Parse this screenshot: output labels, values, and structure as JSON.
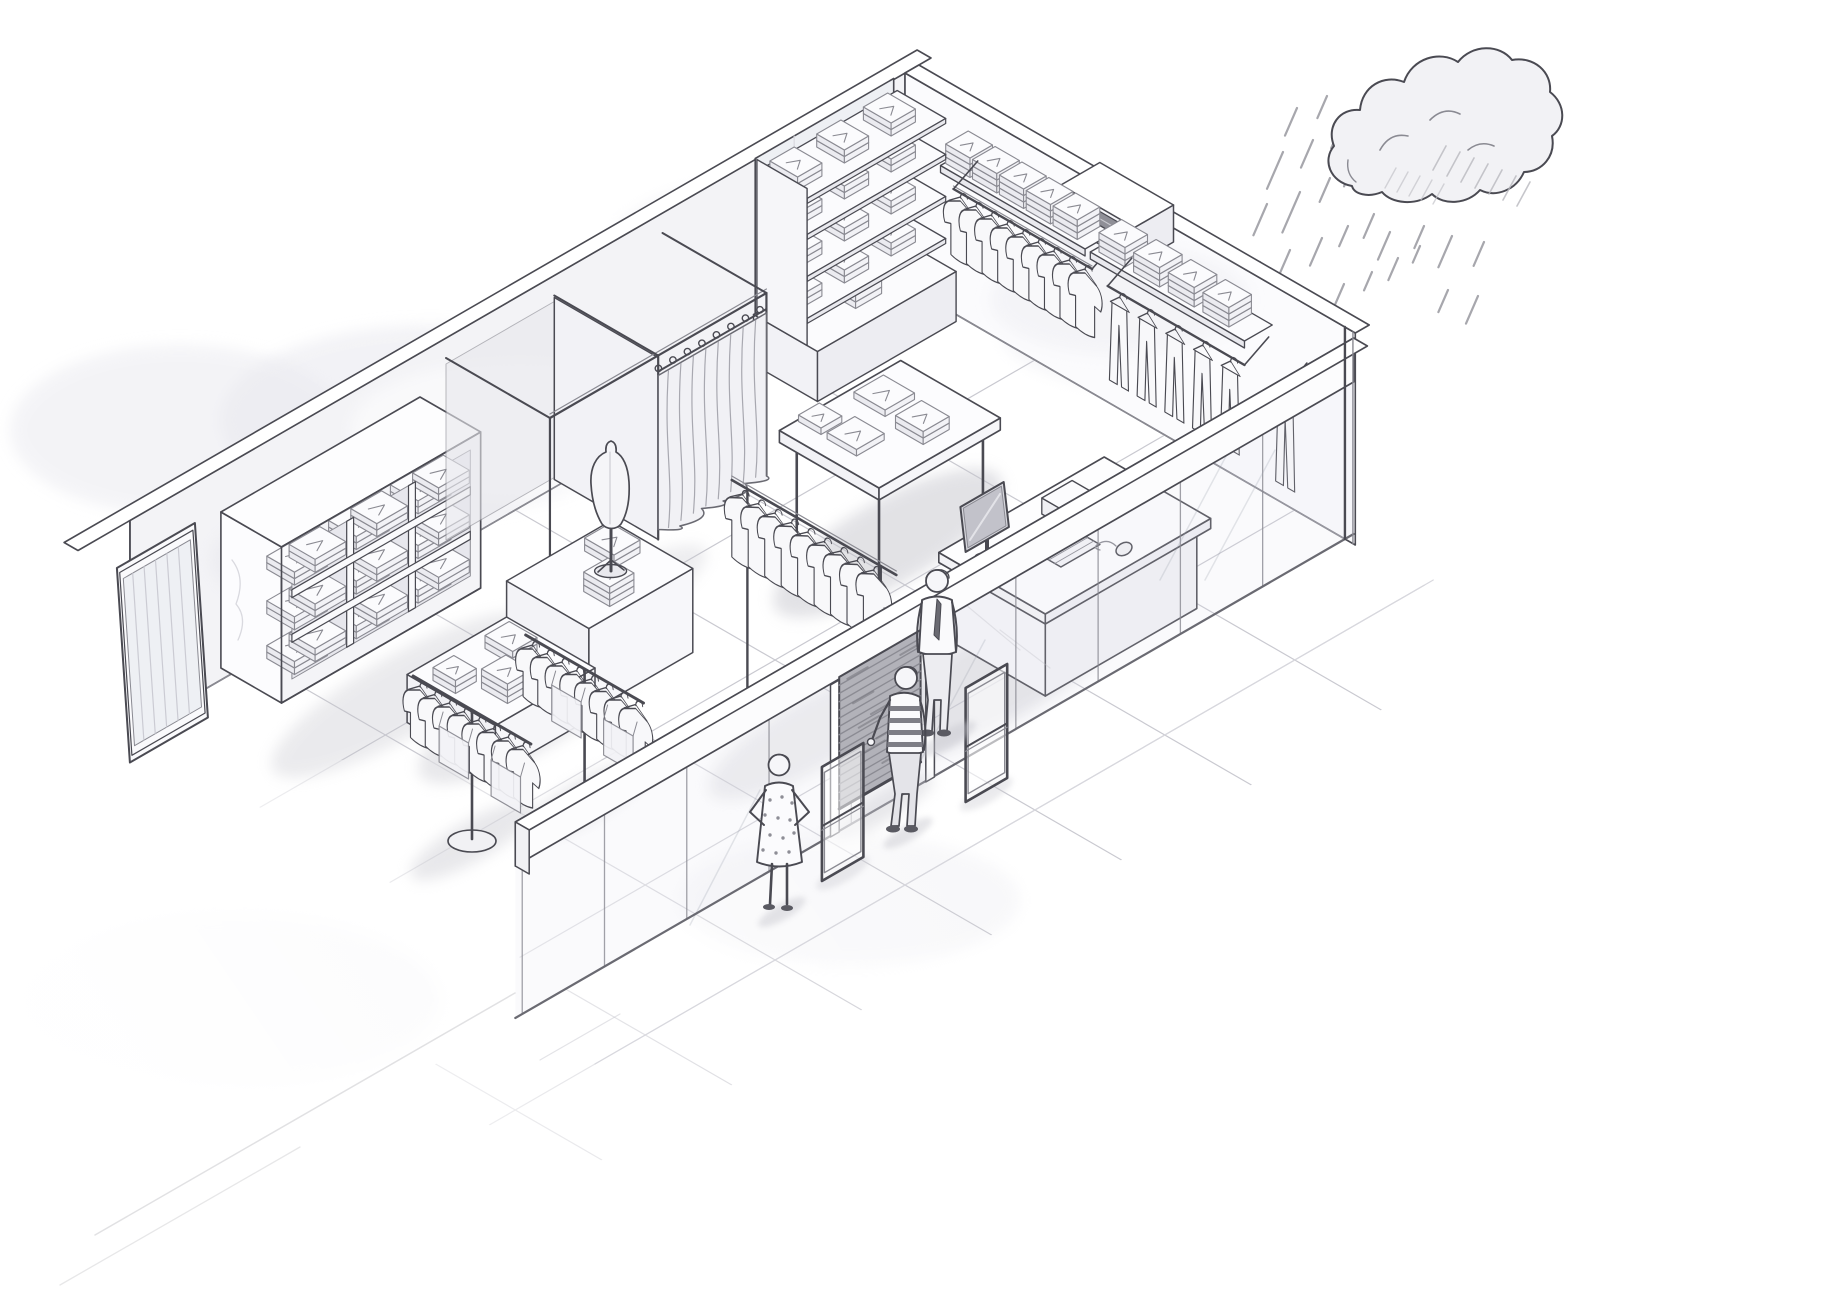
{
  "meta": {
    "title": "Clothing store interior - isometric pencil sketch",
    "medium": "grayscale pencil sketch",
    "view": "isometric cutaway"
  },
  "palette": {
    "background": "#ffffff",
    "ink": "#4a4a52",
    "ink_soft": "#8a8a92",
    "ink_faint": "#c9c9d0",
    "wall_left": "#f3f3f6",
    "wall_right": "#fbfbfd",
    "paper_shade": "#e9e9ef",
    "glass": "#dfe3ea",
    "cloth": "#f8f8fa",
    "shutter": "#b2b2b9",
    "shutter_line": "#8b8b93",
    "shadow": "#c6c6cd",
    "dark_detail": "#6a6a72"
  },
  "weather": {
    "element": "rain-cloud",
    "rain_streak_count": 26
  },
  "store": {
    "floor": {
      "style": "large-tile-grid",
      "tile_step": 150
    },
    "walls": {
      "left": "blank-wall-with-mirror",
      "right": "merchandise-wall"
    },
    "storefront": {
      "beam": "white-bulkhead",
      "glass_mullions": 9,
      "door": {
        "type": "roller-shutter",
        "state": "mostly-closed"
      },
      "security_gate_count": 2
    },
    "fixtures": [
      {
        "id": "wall-mirror",
        "type": "leaning-frame-mirror"
      },
      {
        "id": "cubby-shelf-unit",
        "rows": 3,
        "cols": 3,
        "contents": "folded-clothes"
      },
      {
        "id": "fitting-rooms",
        "stalls": 2,
        "curtains_closed": 1
      },
      {
        "id": "tall-wall-shelf",
        "shelf_count": 4,
        "stacks_per_shelf": 3
      },
      {
        "id": "wall-shelf-rail-1",
        "shelf_stacks": 5,
        "hanging_shirts": 9
      },
      {
        "id": "wall-shelf-rail-2",
        "shelf_stacks": 4,
        "hanging_garments": 5
      },
      {
        "id": "corner-hanging-garment",
        "hanging_garments": 1
      },
      {
        "id": "vent-box",
        "type": "slatted-grille-box"
      },
      {
        "id": "center-display-table",
        "folded_items": 4
      },
      {
        "id": "t-stand-rack",
        "hanging_shirts": 9
      },
      {
        "id": "stepped-display-table",
        "tiers": 2,
        "folded_stacks": 5,
        "mannequin": "dress-form"
      },
      {
        "id": "pedestal-rack-1",
        "hanging_shirts": 8,
        "sign_tags": 2
      },
      {
        "id": "pedestal-rack-2",
        "hanging_shirts": 8,
        "sign_tags": 2
      },
      {
        "id": "checkout-counter",
        "equipment": [
          "monitor",
          "keyboard",
          "mouse",
          "printer-box"
        ]
      }
    ],
    "people": [
      {
        "id": "customer-woman",
        "outfit": "polka-dot-dress",
        "pose": "hands-on-hips"
      },
      {
        "id": "customer-man",
        "outfit": "striped-shirt",
        "pose": "reaching-to-shutter"
      },
      {
        "id": "staff-man",
        "outfit": "shirt-and-tie",
        "pose": "standing"
      }
    ]
  }
}
